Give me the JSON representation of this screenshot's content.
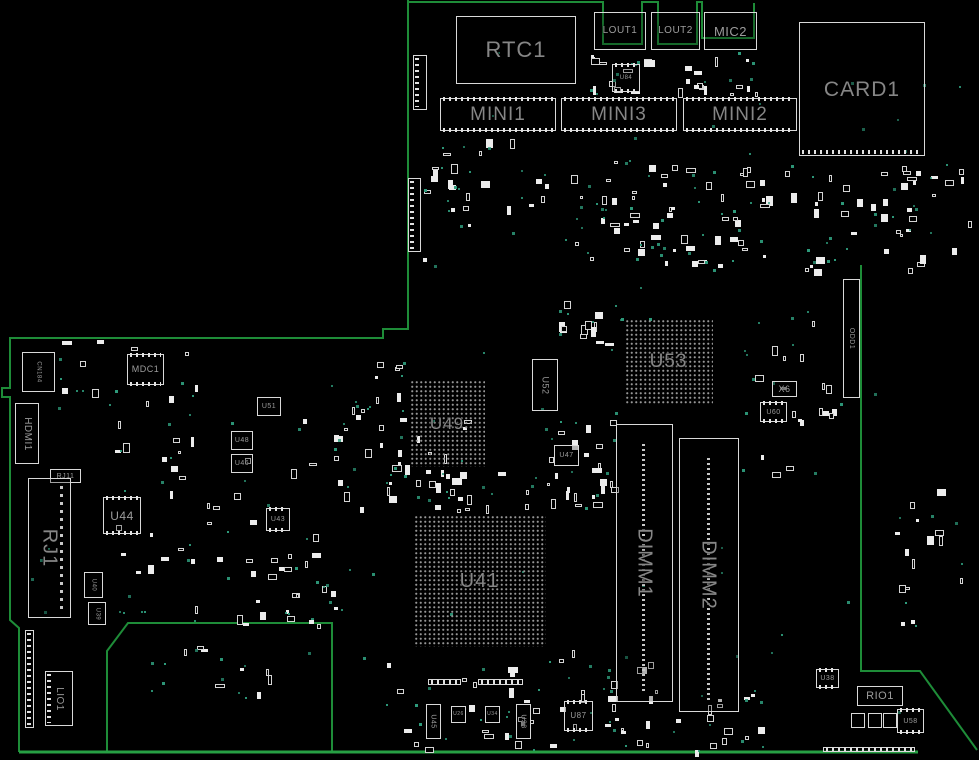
{
  "title": "Motherboard boardview",
  "colors": {
    "background": "#000000",
    "board_outline": "#1e8c38",
    "bottom_edge": "#27a044",
    "part_outline": "#d9d9d9",
    "label_large": "#868686",
    "label_small": "#9c9c9c",
    "via_dot": "#2e9c7c"
  },
  "components": [
    {
      "label": "RTC1",
      "x": 456,
      "y": 16,
      "w": 120,
      "h": 68,
      "fs": 22,
      "vert": false,
      "kind": "box"
    },
    {
      "label": "LOUT1",
      "x": 594,
      "y": 12,
      "w": 52,
      "h": 38,
      "fs": 10,
      "vert": false,
      "kind": "box"
    },
    {
      "label": "LOUT2",
      "x": 651,
      "y": 12,
      "w": 49,
      "h": 38,
      "fs": 10,
      "vert": false,
      "kind": "box"
    },
    {
      "label": "MIC2",
      "x": 704,
      "y": 12,
      "w": 53,
      "h": 38,
      "fs": 13,
      "vert": false,
      "kind": "box"
    },
    {
      "label": "MINI1",
      "x": 440,
      "y": 98,
      "w": 116,
      "h": 33,
      "fs": 19,
      "vert": false,
      "kind": "mini"
    },
    {
      "label": "MINI3",
      "x": 561,
      "y": 98,
      "w": 116,
      "h": 33,
      "fs": 19,
      "vert": false,
      "kind": "mini"
    },
    {
      "label": "MINI2",
      "x": 683,
      "y": 98,
      "w": 114,
      "h": 33,
      "fs": 19,
      "vert": false,
      "kind": "mini"
    },
    {
      "label": "CARD1",
      "x": 799,
      "y": 22,
      "w": 126,
      "h": 134,
      "fs": 21,
      "vert": false,
      "kind": "card"
    },
    {
      "label": "U84",
      "x": 612,
      "y": 64,
      "w": 28,
      "h": 28,
      "fs": 6,
      "vert": false,
      "kind": "chip"
    },
    {
      "label": "U53",
      "x": 624,
      "y": 318,
      "w": 89,
      "h": 86,
      "fs": 19,
      "vert": false,
      "kind": "bga"
    },
    {
      "label": "U49",
      "x": 409,
      "y": 379,
      "w": 76,
      "h": 88,
      "fs": 17,
      "vert": false,
      "kind": "bga"
    },
    {
      "label": "U41",
      "x": 413,
      "y": 514,
      "w": 133,
      "h": 133,
      "fs": 20,
      "vert": false,
      "kind": "bga"
    },
    {
      "label": "U52",
      "x": 532,
      "y": 359,
      "w": 26,
      "h": 52,
      "fs": 9,
      "vert": true,
      "kind": "box"
    },
    {
      "label": "U47",
      "x": 554,
      "y": 445,
      "w": 25,
      "h": 21,
      "fs": 7,
      "vert": false,
      "kind": "box"
    },
    {
      "label": "X6",
      "x": 772,
      "y": 381,
      "w": 25,
      "h": 16,
      "fs": 9,
      "vert": false,
      "kind": "box"
    },
    {
      "label": "U60",
      "x": 760,
      "y": 402,
      "w": 27,
      "h": 20,
      "fs": 7,
      "vert": false,
      "kind": "chip"
    },
    {
      "label": "DIMM1",
      "x": 616,
      "y": 424,
      "w": 57,
      "h": 278,
      "fs": 20,
      "vert": true,
      "kind": "dimm"
    },
    {
      "label": "DIMM2",
      "x": 679,
      "y": 438,
      "w": 60,
      "h": 274,
      "fs": 20,
      "vert": true,
      "kind": "dimm"
    },
    {
      "label": "ODD1",
      "x": 843,
      "y": 279,
      "w": 17,
      "h": 119,
      "fs": 7,
      "vert": true,
      "kind": "odd"
    },
    {
      "label": "CN184",
      "x": 22,
      "y": 352,
      "w": 33,
      "h": 40,
      "fs": 6,
      "vert": true,
      "kind": "box"
    },
    {
      "label": "MDC1",
      "x": 127,
      "y": 354,
      "w": 37,
      "h": 31,
      "fs": 9,
      "vert": false,
      "kind": "mini"
    },
    {
      "label": "HDMI1",
      "x": 15,
      "y": 403,
      "w": 24,
      "h": 61,
      "fs": 10,
      "vert": true,
      "kind": "box"
    },
    {
      "label": "RJ11",
      "x": 50,
      "y": 469,
      "w": 31,
      "h": 14,
      "fs": 7,
      "vert": false,
      "kind": "box"
    },
    {
      "label": "RJ1",
      "x": 28,
      "y": 478,
      "w": 43,
      "h": 140,
      "fs": 20,
      "vert": true,
      "kind": "rj"
    },
    {
      "label": "U44",
      "x": 103,
      "y": 497,
      "w": 38,
      "h": 37,
      "fs": 12,
      "vert": false,
      "kind": "chip"
    },
    {
      "label": "U40",
      "x": 84,
      "y": 572,
      "w": 19,
      "h": 26,
      "fs": 6,
      "vert": true,
      "kind": "box"
    },
    {
      "label": "U39",
      "x": 88,
      "y": 602,
      "w": 18,
      "h": 23,
      "fs": 6,
      "vert": true,
      "kind": "box"
    },
    {
      "label": "U51",
      "x": 257,
      "y": 397,
      "w": 24,
      "h": 19,
      "fs": 7,
      "vert": false,
      "kind": "box"
    },
    {
      "label": "U48",
      "x": 231,
      "y": 431,
      "w": 22,
      "h": 19,
      "fs": 7,
      "vert": false,
      "kind": "box"
    },
    {
      "label": "U46",
      "x": 231,
      "y": 454,
      "w": 22,
      "h": 19,
      "fs": 7,
      "vert": false,
      "kind": "box"
    },
    {
      "label": "U43",
      "x": 266,
      "y": 508,
      "w": 24,
      "h": 23,
      "fs": 7,
      "vert": false,
      "kind": "chip"
    },
    {
      "label": "LIO1",
      "x": 45,
      "y": 671,
      "w": 28,
      "h": 55,
      "fs": 10,
      "vert": true,
      "kind": "conn"
    },
    {
      "label": "U45",
      "x": 426,
      "y": 704,
      "w": 15,
      "h": 35,
      "fs": 7,
      "vert": true,
      "kind": "box"
    },
    {
      "label": "U26",
      "x": 451,
      "y": 706,
      "w": 15,
      "h": 17,
      "fs": 5,
      "vert": false,
      "kind": "box"
    },
    {
      "label": "U34",
      "x": 485,
      "y": 706,
      "w": 15,
      "h": 17,
      "fs": 5,
      "vert": false,
      "kind": "box"
    },
    {
      "label": "U33",
      "x": 516,
      "y": 704,
      "w": 15,
      "h": 35,
      "fs": 7,
      "vert": true,
      "kind": "box"
    },
    {
      "label": "U87",
      "x": 564,
      "y": 701,
      "w": 29,
      "h": 30,
      "fs": 8,
      "vert": false,
      "kind": "chip"
    },
    {
      "label": "U38",
      "x": 816,
      "y": 669,
      "w": 23,
      "h": 19,
      "fs": 7,
      "vert": false,
      "kind": "chip"
    },
    {
      "label": "RIO1",
      "x": 857,
      "y": 686,
      "w": 46,
      "h": 20,
      "fs": 11,
      "vert": false,
      "kind": "box"
    },
    {
      "label": "U58",
      "x": 897,
      "y": 709,
      "w": 27,
      "h": 24,
      "fs": 7,
      "vert": false,
      "kind": "chip"
    },
    {
      "label": "",
      "name": "connector-left-bottom",
      "x": 25,
      "y": 630,
      "w": 9,
      "h": 98,
      "fs": 0,
      "vert": true,
      "kind": "conn"
    },
    {
      "label": "",
      "name": "connector-top-a",
      "x": 413,
      "y": 55,
      "w": 14,
      "h": 55,
      "fs": 0,
      "vert": true,
      "kind": "conn"
    },
    {
      "label": "",
      "name": "connector-top-b",
      "x": 408,
      "y": 178,
      "w": 13,
      "h": 74,
      "fs": 0,
      "vert": true,
      "kind": "conn"
    },
    {
      "label": "",
      "name": "tick-strip-a",
      "x": 428,
      "y": 679,
      "w": 33,
      "h": 6,
      "fs": 0,
      "vert": false,
      "kind": "strip"
    },
    {
      "label": "",
      "name": "tick-strip-b",
      "x": 478,
      "y": 679,
      "w": 45,
      "h": 6,
      "fs": 0,
      "vert": false,
      "kind": "strip"
    },
    {
      "label": "",
      "name": "tick-strip-c",
      "x": 823,
      "y": 747,
      "w": 92,
      "h": 5,
      "fs": 0,
      "vert": false,
      "kind": "strip"
    },
    {
      "label": "",
      "name": "pad-a",
      "x": 851,
      "y": 713,
      "w": 14,
      "h": 15,
      "fs": 0,
      "vert": false,
      "kind": "pad"
    },
    {
      "label": "",
      "name": "pad-b",
      "x": 868,
      "y": 713,
      "w": 14,
      "h": 15,
      "fs": 0,
      "vert": false,
      "kind": "pad"
    },
    {
      "label": "",
      "name": "pad-c",
      "x": 883,
      "y": 713,
      "w": 14,
      "h": 15,
      "fs": 0,
      "vert": false,
      "kind": "pad"
    }
  ],
  "decor": {
    "seed": 13,
    "clusters": [
      {
        "x": 585,
        "y": 55,
        "w": 175,
        "h": 40,
        "parts": 26,
        "dots": 10
      },
      {
        "x": 440,
        "y": 135,
        "w": 110,
        "h": 80,
        "parts": 12,
        "dots": 8
      },
      {
        "x": 555,
        "y": 160,
        "w": 215,
        "h": 105,
        "parts": 55,
        "dots": 30
      },
      {
        "x": 775,
        "y": 170,
        "w": 160,
        "h": 100,
        "parts": 26,
        "dots": 12
      },
      {
        "x": 895,
        "y": 480,
        "w": 70,
        "h": 150,
        "parts": 14,
        "dots": 6
      },
      {
        "x": 115,
        "y": 415,
        "w": 200,
        "h": 215,
        "parts": 40,
        "dots": 18
      },
      {
        "x": 330,
        "y": 420,
        "w": 140,
        "h": 90,
        "parts": 26,
        "dots": 12
      },
      {
        "x": 545,
        "y": 408,
        "w": 75,
        "h": 100,
        "parts": 22,
        "dots": 10
      },
      {
        "x": 742,
        "y": 315,
        "w": 95,
        "h": 160,
        "parts": 18,
        "dots": 10
      },
      {
        "x": 380,
        "y": 650,
        "w": 280,
        "h": 100,
        "parts": 34,
        "dots": 16
      },
      {
        "x": 600,
        "y": 690,
        "w": 165,
        "h": 62,
        "parts": 22,
        "dots": 12
      },
      {
        "x": 55,
        "y": 340,
        "w": 150,
        "h": 70,
        "parts": 10,
        "dots": 6
      },
      {
        "x": 415,
        "y": 470,
        "w": 130,
        "h": 40,
        "parts": 14,
        "dots": 8
      },
      {
        "x": 557,
        "y": 300,
        "w": 65,
        "h": 60,
        "parts": 12,
        "dots": 8
      },
      {
        "x": 893,
        "y": 160,
        "w": 80,
        "h": 105,
        "parts": 14,
        "dots": 4
      },
      {
        "x": 410,
        "y": 160,
        "w": 60,
        "h": 100,
        "parts": 10,
        "dots": 5
      },
      {
        "x": 255,
        "y": 555,
        "w": 90,
        "h": 70,
        "parts": 12,
        "dots": 6
      },
      {
        "x": 150,
        "y": 640,
        "w": 120,
        "h": 60,
        "parts": 8,
        "dots": 10
      },
      {
        "x": 340,
        "y": 360,
        "w": 70,
        "h": 60,
        "parts": 10,
        "dots": 6
      },
      {
        "x": 420,
        "y": 40,
        "w": 540,
        "h": 290,
        "parts": 0,
        "dots": 30
      },
      {
        "x": 30,
        "y": 350,
        "w": 900,
        "h": 390,
        "parts": 0,
        "dots": 40
      }
    ]
  }
}
